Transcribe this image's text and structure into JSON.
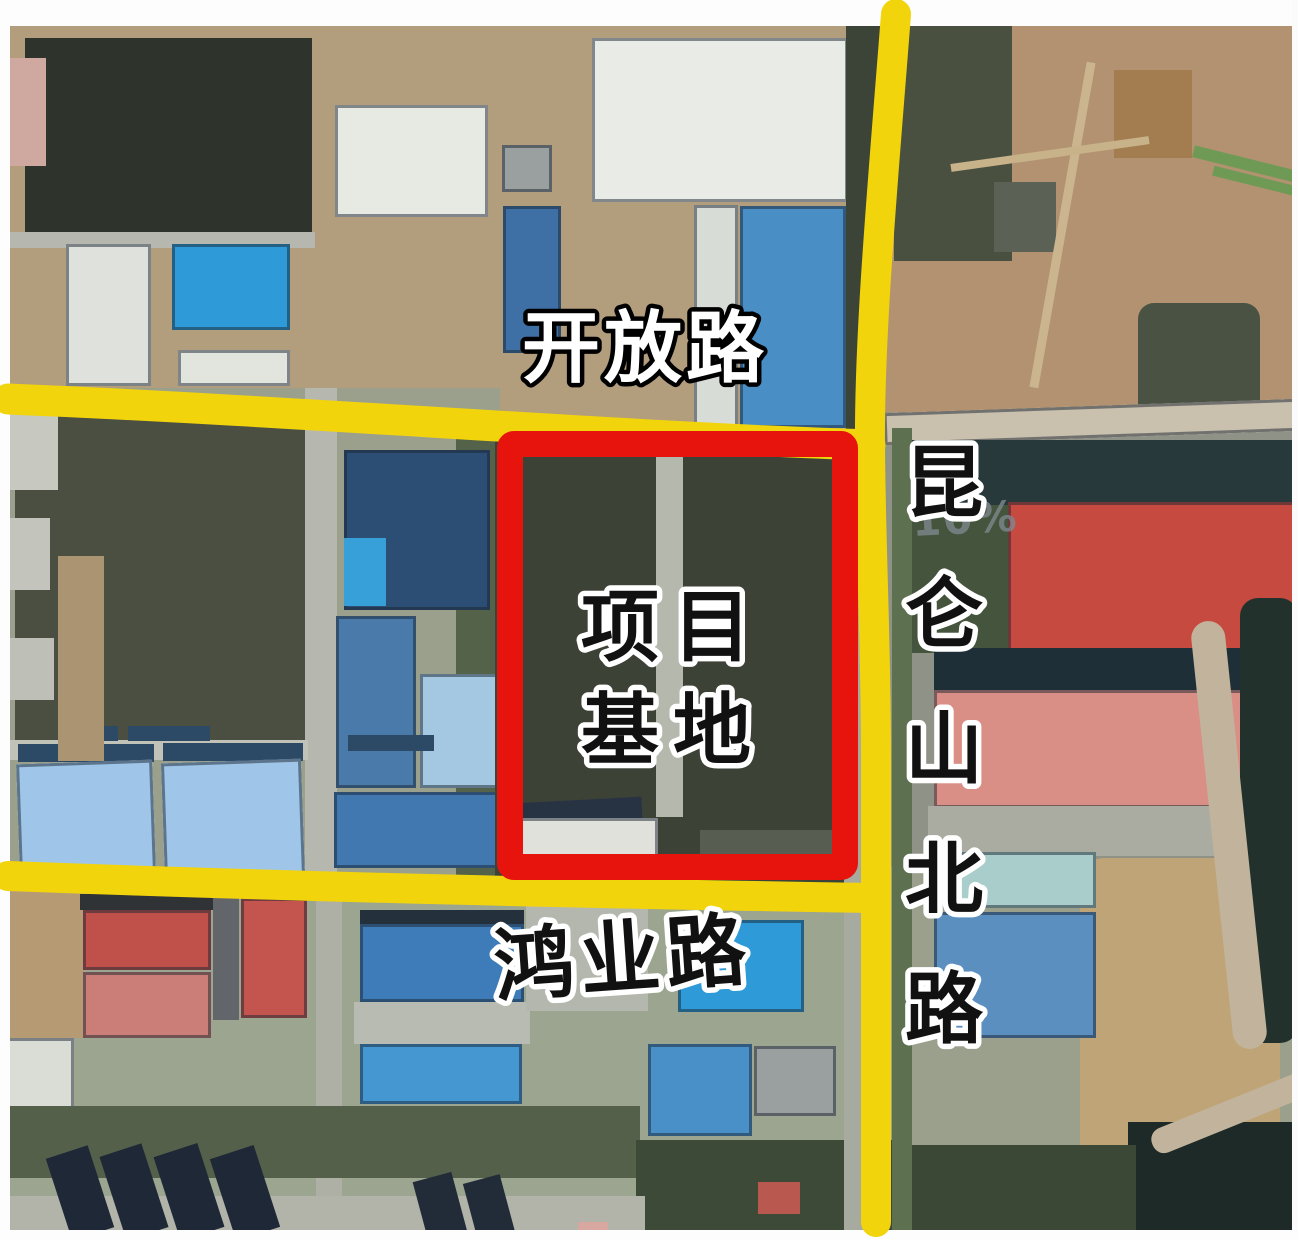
{
  "labels": {
    "road_top": "开放路",
    "site_line1": "项目",
    "site_line2": "基地",
    "road_bottom": "鸿业路",
    "road_right_chars": [
      "昆",
      "仑",
      "山",
      "北",
      "路"
    ],
    "watermark": "10%"
  },
  "colors": {
    "road_yellow": "#f2d40c",
    "boundary_red": "#e6140c",
    "label_white": "#ffffff",
    "label_black": "#111111",
    "outline_white": "#ffffff",
    "outline_black": "#000000",
    "watermark_gray": "#7f878d"
  },
  "roads": {
    "kaifang": "M 8 399 C 300 411 620 437 870 445",
    "hongye": "M 8 876 C 300 887 620 894 872 898",
    "kunlun": "M 896 14 C 884 170 869 330 870 446 C 871 560 876 640 876 760 L 876 1222"
  },
  "boundary": {
    "x": 510,
    "y": 444,
    "w": 335,
    "h": 423
  },
  "features": [
    {
      "n": "ground-topleft",
      "x": 0,
      "y": 20,
      "w": 900,
      "h": 420,
      "c": "#b29d7d",
      "tex": "mottle"
    },
    {
      "n": "ground-topright",
      "x": 880,
      "y": 20,
      "w": 418,
      "h": 420,
      "c": "#b29270",
      "tex": "mottle"
    },
    {
      "n": "ground-midleft",
      "x": 0,
      "y": 388,
      "w": 500,
      "h": 510,
      "c": "#9aa08c",
      "tex": "mottle"
    },
    {
      "n": "ground-right-mid",
      "x": 878,
      "y": 412,
      "w": 420,
      "h": 455,
      "c": "#8f9286",
      "tex": "mottle"
    },
    {
      "n": "ground-bottom",
      "x": 0,
      "y": 888,
      "w": 885,
      "h": 352,
      "c": "#9ba590",
      "tex": "mottle"
    },
    {
      "n": "trees-east-of-road-top",
      "x": 894,
      "y": 26,
      "w": 118,
      "h": 235,
      "c": "#49503f",
      "tex": "mottle2"
    },
    {
      "n": "field-dark-left",
      "x": 15,
      "y": 408,
      "w": 296,
      "h": 352,
      "c": "#4a4f41",
      "tex": "mottle2",
      "rad": 14
    },
    {
      "n": "farmland-dark",
      "x": 25,
      "y": 38,
      "w": 287,
      "h": 194,
      "c": "#2e332b",
      "tex": "mottle2"
    },
    {
      "n": "road-gray-topleft",
      "x": 0,
      "y": 232,
      "w": 315,
      "h": 16,
      "c": "#b6b8af"
    },
    {
      "n": "bldg-pink-fragment",
      "x": 0,
      "y": 58,
      "w": 46,
      "h": 108,
      "c": "#cfa8a0",
      "tex": "ridge"
    },
    {
      "n": "bldg-white-left",
      "x": 66,
      "y": 244,
      "w": 85,
      "h": 142,
      "c": "#dfe2dc",
      "bd": 1
    },
    {
      "n": "bldg-blue-left",
      "x": 172,
      "y": 244,
      "w": 118,
      "h": 86,
      "c": "#2f9ad8",
      "bd": 1
    },
    {
      "n": "bldg-white-left2",
      "x": 178,
      "y": 350,
      "w": 112,
      "h": 36,
      "c": "#e2e4de",
      "bd": 1
    },
    {
      "n": "bldg-white-topmid",
      "x": 335,
      "y": 105,
      "w": 153,
      "h": 112,
      "c": "#e7e9e3",
      "bd": 1
    },
    {
      "n": "bldg-gray-small",
      "x": 502,
      "y": 145,
      "w": 50,
      "h": 47,
      "c": "#9aa0a0",
      "bd": 1
    },
    {
      "n": "bldg-blue-solar-small",
      "x": 503,
      "y": 206,
      "w": 58,
      "h": 147,
      "c": "#3f70a5",
      "tex": "panelsH",
      "bd": 1
    },
    {
      "n": "bldg-white-big",
      "x": 592,
      "y": 38,
      "w": 256,
      "h": 164,
      "c": "#e9ebe6",
      "bd": 1
    },
    {
      "n": "bldg-white-strip",
      "x": 694,
      "y": 205,
      "w": 44,
      "h": 223,
      "c": "#d8dcd6",
      "bd": 1
    },
    {
      "n": "bldg-blue-tall",
      "x": 740,
      "y": 206,
      "w": 106,
      "h": 222,
      "c": "#4a8ec6",
      "tex": "panelsH",
      "bd": 1
    },
    {
      "n": "trees-west-of-road",
      "x": 846,
      "y": 24,
      "w": 36,
      "h": 406,
      "c": "#3c4437",
      "tex": "mottle2"
    },
    {
      "n": "dirt-square-topright",
      "x": 1114,
      "y": 70,
      "w": 78,
      "h": 88,
      "c": "#a37d4f"
    },
    {
      "n": "green-diag-1",
      "x": 1192,
      "y": 158,
      "w": 106,
      "h": 12,
      "c": "#6f9a55",
      "r": 14
    },
    {
      "n": "green-diag-2",
      "x": 1212,
      "y": 176,
      "w": 86,
      "h": 10,
      "c": "#6f9a55",
      "r": 14
    },
    {
      "n": "dark-patch-topright",
      "x": 994,
      "y": 182,
      "w": 62,
      "h": 70,
      "c": "#5c6156"
    },
    {
      "n": "veg-dark-topright",
      "x": 1138,
      "y": 303,
      "w": 122,
      "h": 128,
      "c": "#4a5243",
      "tex": "mottle2",
      "rad": 16
    },
    {
      "n": "track-topright-v",
      "x": 1058,
      "y": 60,
      "w": 9,
      "h": 330,
      "c": "#cbb58e",
      "r": 10
    },
    {
      "n": "track-topright-h",
      "x": 950,
      "y": 150,
      "w": 200,
      "h": 8,
      "c": "#c7b28a",
      "r": -8
    },
    {
      "n": "road-diag-right",
      "x": 884,
      "y": 406,
      "w": 414,
      "h": 32,
      "c": "#c9c0ae",
      "r": -2,
      "bd": 1
    },
    {
      "n": "band-dark-right",
      "x": 902,
      "y": 440,
      "w": 396,
      "h": 68,
      "c": "#27393b",
      "tex": "ridge"
    },
    {
      "n": "trees-left-of-red1",
      "x": 902,
      "y": 505,
      "w": 106,
      "h": 148,
      "c": "#44543d",
      "tex": "mottle2"
    },
    {
      "n": "bldg-red-1",
      "x": 1008,
      "y": 502,
      "w": 290,
      "h": 158,
      "c": "#c64a40",
      "tex": "panelsV",
      "bd": 1
    },
    {
      "n": "shadow-band-red",
      "x": 934,
      "y": 648,
      "w": 364,
      "h": 44,
      "c": "#1f2f38"
    },
    {
      "n": "bldg-red-2",
      "x": 934,
      "y": 690,
      "w": 318,
      "h": 118,
      "c": "#d98f85",
      "tex": "stripesV",
      "bd": 1
    },
    {
      "n": "concrete-below-red2",
      "x": 928,
      "y": 806,
      "w": 332,
      "h": 50,
      "c": "#aaaca1"
    },
    {
      "n": "ground-tan-right",
      "x": 1080,
      "y": 858,
      "w": 200,
      "h": 315,
      "c": "#bfa478",
      "tex": "mottle",
      "rad": 24
    },
    {
      "n": "dark-edge-right",
      "x": 1240,
      "y": 598,
      "w": 58,
      "h": 445,
      "c": "#23312d",
      "rad": 18
    },
    {
      "n": "dark-corner-bottomright",
      "x": 1128,
      "y": 1122,
      "w": 170,
      "h": 118,
      "c": "#1d2a27"
    },
    {
      "n": "road-curve-right",
      "x": 1212,
      "y": 620,
      "w": 34,
      "h": 430,
      "c": "#c2b49c",
      "r": -6,
      "rad": 40
    },
    {
      "n": "road-curve-right2",
      "x": 1146,
      "y": 1098,
      "w": 180,
      "h": 26,
      "c": "#c2b49c",
      "r": -22,
      "rad": 12
    },
    {
      "n": "bldg-teal",
      "x": 934,
      "y": 852,
      "w": 162,
      "h": 56,
      "c": "#a9cdcb",
      "bd": 1
    },
    {
      "n": "bldg-blue-right",
      "x": 934,
      "y": 912,
      "w": 162,
      "h": 126,
      "c": "#5b8fc0",
      "tex": "panelsH",
      "bd": 1
    },
    {
      "n": "trees-bottomright",
      "x": 896,
      "y": 1145,
      "w": 240,
      "h": 92,
      "c": "#3c4836",
      "tex": "mottle2"
    },
    {
      "n": "road-gray-mid",
      "x": 305,
      "y": 388,
      "w": 32,
      "h": 502,
      "c": "#b6b8af"
    },
    {
      "n": "road-gray-mid-lower",
      "x": 316,
      "y": 890,
      "w": 26,
      "h": 330,
      "c": "#aeb0a6"
    },
    {
      "n": "trees-east-field",
      "x": 456,
      "y": 430,
      "w": 40,
      "h": 452,
      "c": "#55624a",
      "tex": "mottle2"
    },
    {
      "n": "bldg-blue-solar-big",
      "x": 344,
      "y": 450,
      "w": 146,
      "h": 160,
      "c": "#2c4e74",
      "tex": "panelsH",
      "bd": 1
    },
    {
      "n": "patch-lightblue",
      "x": 344,
      "y": 538,
      "w": 42,
      "h": 68,
      "c": "#38a0d8"
    },
    {
      "n": "bldg-blue-grid",
      "x": 336,
      "y": 616,
      "w": 80,
      "h": 172,
      "c": "#4a7aaa",
      "tex": "grid",
      "bd": 1
    },
    {
      "n": "bldg-lightblue",
      "x": 420,
      "y": 674,
      "w": 80,
      "h": 114,
      "c": "#a4c8e2",
      "bd": 1
    },
    {
      "n": "bldg-blue-mid-low",
      "x": 334,
      "y": 792,
      "w": 164,
      "h": 76,
      "c": "#4178b0",
      "tex": "panelsH",
      "bd": 1
    },
    {
      "n": "road-gray-above-greenhouse",
      "x": 0,
      "y": 740,
      "w": 308,
      "h": 20,
      "c": "#c1c3b9"
    },
    {
      "n": "roof-darkblue-1",
      "x": 58,
      "y": 726,
      "w": 60,
      "h": 15,
      "c": "#2c4a66"
    },
    {
      "n": "roof-darkblue-2",
      "x": 128,
      "y": 726,
      "w": 82,
      "h": 15,
      "c": "#2c4a66"
    },
    {
      "n": "roof-darkblue-3",
      "x": 348,
      "y": 735,
      "w": 86,
      "h": 16,
      "c": "#2c4a66"
    },
    {
      "n": "greenhouse-1-top",
      "x": 18,
      "y": 744,
      "w": 136,
      "h": 18,
      "c": "#2c4a66"
    },
    {
      "n": "greenhouse-1",
      "x": 18,
      "y": 762,
      "w": 136,
      "h": 110,
      "c": "#9fc6e8",
      "tex": "stripesV",
      "bd": 1,
      "r": -2
    },
    {
      "n": "greenhouse-2-top",
      "x": 163,
      "y": 743,
      "w": 140,
      "h": 18,
      "c": "#2c4a66"
    },
    {
      "n": "greenhouse-2",
      "x": 163,
      "y": 761,
      "w": 140,
      "h": 118,
      "c": "#9fc6e8",
      "tex": "stripesV",
      "bd": 1,
      "r": -2
    },
    {
      "n": "frag-1",
      "x": 0,
      "y": 398,
      "w": 58,
      "h": 92,
      "c": "#c7c9c1"
    },
    {
      "n": "frag-2",
      "x": 0,
      "y": 518,
      "w": 50,
      "h": 72,
      "c": "#c3c5bd"
    },
    {
      "n": "frag-3",
      "x": 0,
      "y": 638,
      "w": 54,
      "h": 62,
      "c": "#bec0b8"
    },
    {
      "n": "path-tan-left",
      "x": 58,
      "y": 556,
      "w": 46,
      "h": 205,
      "c": "#aa9471",
      "tex": "mottle"
    },
    {
      "n": "site-interior",
      "x": 495,
      "y": 430,
      "w": 363,
      "h": 460,
      "c": "#3d4237",
      "tex": "mottle2"
    },
    {
      "n": "site-road",
      "x": 656,
      "y": 432,
      "w": 27,
      "h": 385,
      "c": "#b4b8ad"
    },
    {
      "n": "site-bldg-roof",
      "x": 514,
      "y": 800,
      "w": 128,
      "h": 22,
      "c": "#273343",
      "r": -3
    },
    {
      "n": "site-bldg-white",
      "x": 516,
      "y": 818,
      "w": 142,
      "h": 54,
      "c": "#dfe1da",
      "tex": "ridge",
      "bd": 1
    },
    {
      "n": "site-patch",
      "x": 700,
      "y": 830,
      "w": 145,
      "h": 30,
      "c": "#6a6f63",
      "o": 0.6
    },
    {
      "n": "dirt-bottomleft",
      "x": 0,
      "y": 890,
      "w": 84,
      "h": 148,
      "c": "#b59a74",
      "tex": "mottle"
    },
    {
      "n": "bldg-redA-shadow",
      "x": 80,
      "y": 894,
      "w": 135,
      "h": 16,
      "c": "#2f3335"
    },
    {
      "n": "bldg-redA-upper",
      "x": 83,
      "y": 910,
      "w": 128,
      "h": 60,
      "c": "#c0504a",
      "bd": 1
    },
    {
      "n": "bldg-redA-lower",
      "x": 83,
      "y": 972,
      "w": 128,
      "h": 66,
      "c": "#ca7e77",
      "bd": 1
    },
    {
      "n": "gray-between-red",
      "x": 213,
      "y": 898,
      "w": 26,
      "h": 122,
      "c": "#62666a"
    },
    {
      "n": "bldg-redB",
      "x": 241,
      "y": 898,
      "w": 66,
      "h": 120,
      "c": "#c4554e",
      "bd": 1
    },
    {
      "n": "bldg-blueC-shadow",
      "x": 360,
      "y": 910,
      "w": 164,
      "h": 14,
      "c": "#24303c"
    },
    {
      "n": "bldg-blueC",
      "x": 360,
      "y": 924,
      "w": 164,
      "h": 78,
      "c": "#3d7cb8",
      "tex": "panelsH",
      "bd": 1
    },
    {
      "n": "concrete-belowC",
      "x": 354,
      "y": 1002,
      "w": 176,
      "h": 42,
      "c": "#b8bbb1"
    },
    {
      "n": "bldg-blueD",
      "x": 360,
      "y": 1044,
      "w": 162,
      "h": 60,
      "c": "#4597d2",
      "bd": 1
    },
    {
      "n": "bldg-whiteF",
      "x": 6,
      "y": 1038,
      "w": 68,
      "h": 82,
      "c": "#dadcd6",
      "bd": 1
    },
    {
      "n": "concrete-mid-bottom",
      "x": 526,
      "y": 903,
      "w": 122,
      "h": 108,
      "c": "#b4b7ad"
    },
    {
      "n": "bldg-blue-small",
      "x": 678,
      "y": 920,
      "w": 126,
      "h": 92,
      "c": "#2f9ad8",
      "bd": 1
    },
    {
      "n": "bldg-blue-small2",
      "x": 648,
      "y": 1044,
      "w": 104,
      "h": 92,
      "c": "#4a90c8",
      "bd": 1
    },
    {
      "n": "bldg-gray-small2",
      "x": 754,
      "y": 1046,
      "w": 82,
      "h": 70,
      "c": "#9aa09f",
      "bd": 1
    },
    {
      "n": "trees-band-left",
      "x": 0,
      "y": 1106,
      "w": 640,
      "h": 72,
      "c": "#55604a",
      "tex": "mottle2"
    },
    {
      "n": "trees-band-mid",
      "x": 636,
      "y": 1140,
      "w": 270,
      "h": 100,
      "c": "#3e4a38",
      "tex": "mottle2"
    },
    {
      "n": "ground-bottom-strip",
      "x": 0,
      "y": 1196,
      "w": 645,
      "h": 40,
      "c": "#b2b4aa"
    },
    {
      "n": "roof-res-1",
      "x": 58,
      "y": 1150,
      "w": 44,
      "h": 86,
      "c": "#1e2836",
      "r": -18
    },
    {
      "n": "roof-res-2",
      "x": 112,
      "y": 1148,
      "w": 44,
      "h": 88,
      "c": "#1e2836",
      "r": -18
    },
    {
      "n": "roof-res-3",
      "x": 166,
      "y": 1148,
      "w": 46,
      "h": 88,
      "c": "#1e2836",
      "r": -18
    },
    {
      "n": "roof-res-4",
      "x": 222,
      "y": 1150,
      "w": 46,
      "h": 86,
      "c": "#1e2836",
      "r": -18
    },
    {
      "n": "roof-res-5",
      "x": 420,
      "y": 1176,
      "w": 40,
      "h": 62,
      "c": "#222c38",
      "r": -15
    },
    {
      "n": "roof-res-6",
      "x": 470,
      "y": 1178,
      "w": 38,
      "h": 60,
      "c": "#222c38",
      "r": -15
    },
    {
      "n": "hut-pink",
      "x": 578,
      "y": 1222,
      "w": 30,
      "h": 16,
      "c": "#d8a8a0"
    },
    {
      "n": "hut-red",
      "x": 758,
      "y": 1182,
      "w": 42,
      "h": 32,
      "c": "#b8584e"
    },
    {
      "n": "sidewalk-west-kunlun",
      "x": 844,
      "y": 430,
      "w": 26,
      "h": 810,
      "c": "#a7aa9f"
    },
    {
      "n": "green-east-kunlun",
      "x": 892,
      "y": 428,
      "w": 20,
      "h": 804,
      "c": "#5d7050"
    },
    {
      "n": "margin-top",
      "x": 0,
      "y": 0,
      "w": 1298,
      "h": 26,
      "c": "#fdfdfd"
    },
    {
      "n": "margin-left",
      "x": 0,
      "y": 0,
      "w": 10,
      "h": 1240,
      "c": "#fdfdfd"
    },
    {
      "n": "margin-right",
      "x": 1292,
      "y": 0,
      "w": 6,
      "h": 1240,
      "c": "#fbfbfb"
    },
    {
      "n": "margin-bottom",
      "x": 0,
      "y": 1230,
      "w": 1298,
      "h": 10,
      "c": "#fdfdfd"
    }
  ]
}
